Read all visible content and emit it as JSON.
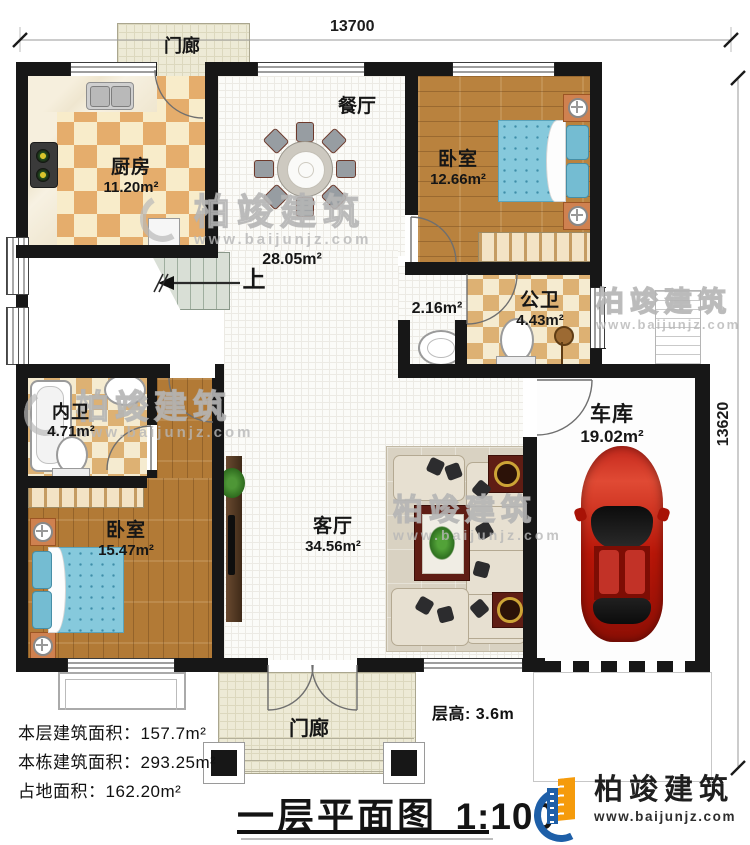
{
  "dimensions": {
    "width_top": "13700",
    "height_right": "13620"
  },
  "rooms": {
    "porch_top": {
      "label": "门廊"
    },
    "kitchen": {
      "label": "厨房",
      "area": "11.20m²"
    },
    "dining": {
      "label": "餐厅",
      "area": "28.05m²"
    },
    "bedroom_top": {
      "label": "卧室",
      "area": "12.66m²"
    },
    "public_bath": {
      "label": "公卫",
      "area": "4.43m²"
    },
    "small_hall": {
      "area": "2.16m²"
    },
    "inner_bath": {
      "label": "内卫",
      "area": "4.71m²"
    },
    "bedroom_left": {
      "label": "卧室",
      "area": "15.47m²"
    },
    "living": {
      "label": "客厅",
      "area": "34.56m²"
    },
    "garage": {
      "label": "车库",
      "area": "19.02m²"
    },
    "porch_bottom": {
      "label": "门廊"
    },
    "stairs": {
      "up": "上"
    }
  },
  "stats": {
    "floor_area": "本层建筑面积：157.7m²",
    "building_area": "本栋建筑面积：293.25m²",
    "land_area": "占地面积：162.20m²",
    "floor_height": "层高: 3.6m"
  },
  "title": {
    "name": "一层平面图",
    "scale": "1:100"
  },
  "brand": {
    "name": "柏竣建筑",
    "url": "www.baijunjz.com"
  },
  "watermark": {
    "name": "柏竣建筑",
    "url": "www.baijunjz.com"
  },
  "colors": {
    "wall": "#171717",
    "wood": "#b9823e",
    "tile": "#e5ad6c",
    "bed": "#86c9dc",
    "car": "#c01d10",
    "logo_blue": "#1e5fa8",
    "logo_orange": "#f59b0c"
  }
}
